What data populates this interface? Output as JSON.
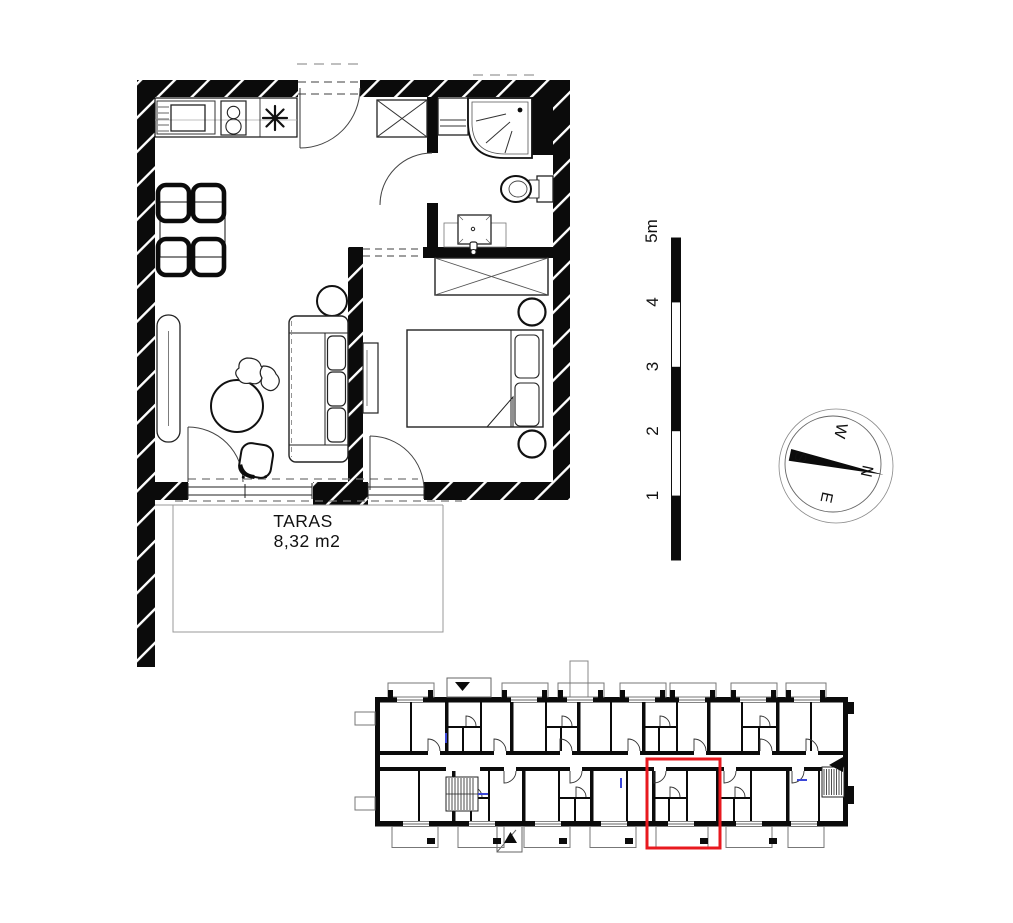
{
  "floor_plan": {
    "terrace_label": "TARAS",
    "terrace_area": "8,32 m2"
  },
  "scale_bar": {
    "labels": [
      "5m",
      "4",
      "3",
      "2",
      "1"
    ]
  },
  "compass": {
    "north": "N",
    "east": "E",
    "south": "S",
    "west": "W"
  },
  "colors": {
    "wall": "#0b0b0b",
    "highlight_red": "#e8191f",
    "door_marker_blue": "#3a46d8"
  }
}
